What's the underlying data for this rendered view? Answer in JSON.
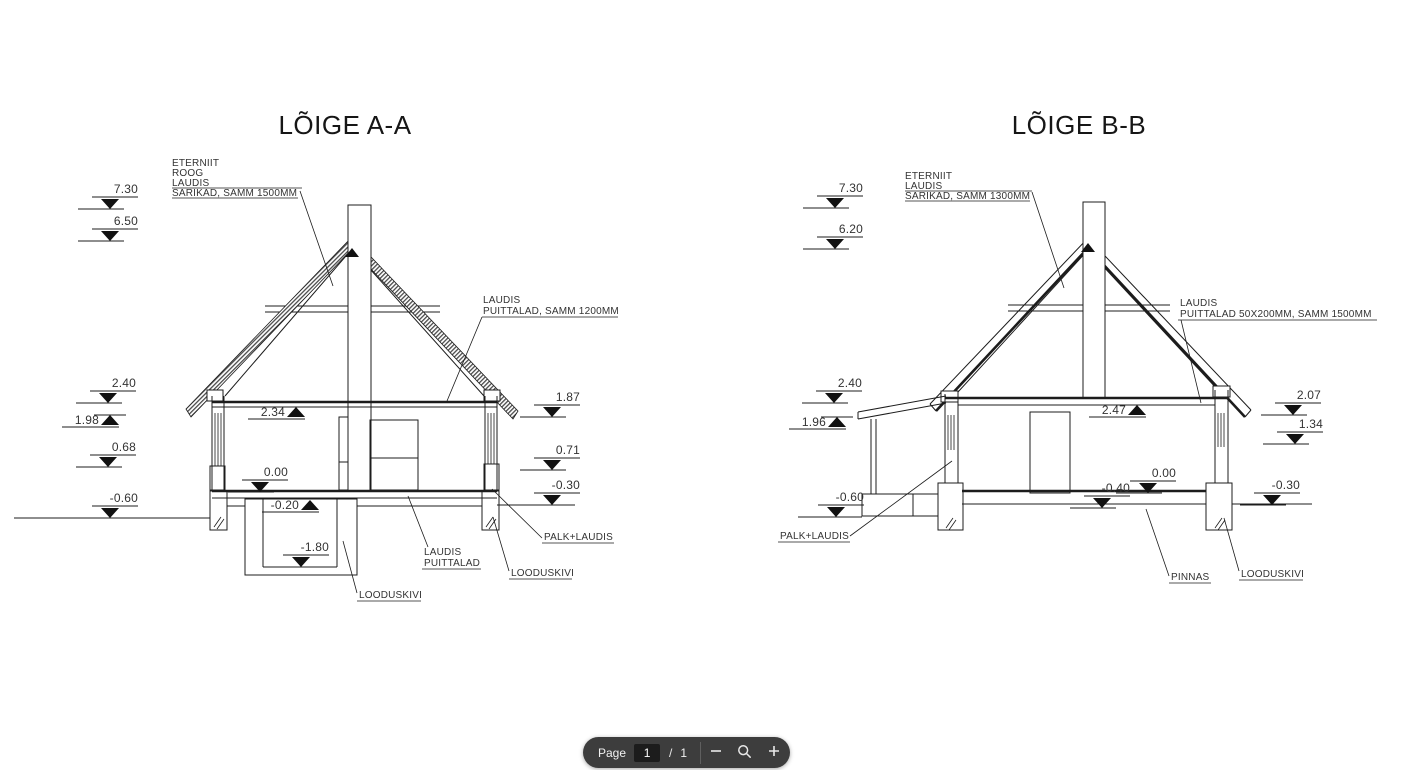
{
  "document": {
    "aa": {
      "title": "LÕIGE A-A",
      "roof_note": [
        "ETERNIIT",
        "ROOG",
        "LAUDIS",
        "SARIKAD, SAMM 1500MM"
      ],
      "beam_note": [
        "LAUDIS",
        "PUITTALAD, SAMM 1200MM"
      ],
      "wall_note": "PALK+LAUDIS",
      "floor_note": [
        "LAUDIS",
        "PUITTALAD"
      ],
      "foundation_note": "LOODUSKIVI",
      "cellar_note": "LOODUSKIVI",
      "elevations": {
        "left": [
          "7.30",
          "6.50",
          "2.40",
          "1.98",
          "0.68",
          "-0.60"
        ],
        "right": [
          "1.87",
          "0.71",
          "-0.30"
        ],
        "inner": [
          "2.34",
          "0.00",
          "-0.20",
          "-1.80"
        ]
      }
    },
    "bb": {
      "title": "LÕIGE B-B",
      "roof_note": [
        "ETERNIIT",
        "LAUDIS",
        "SARIKAD, SAMM 1300MM"
      ],
      "beam_note": [
        "LAUDIS",
        "PUITTALAD 50X200MM, SAMM 1500MM"
      ],
      "wall_note": "PALK+LAUDIS",
      "ground_note": "PINNAS",
      "foundation_note": "LOODUSKIVI",
      "elevations": {
        "left": [
          "7.30",
          "6.20",
          "2.40",
          "1.96",
          "-0.60"
        ],
        "right": [
          "2.07",
          "1.34",
          "-0.30"
        ],
        "inner": [
          "2.47",
          "0.00",
          "-0.40"
        ]
      }
    }
  },
  "toolbar": {
    "page_label": "Page",
    "page_value": "1",
    "separator": "/",
    "total_pages": "1",
    "icons": {
      "zoom_out": "minus-icon",
      "zoom_tool": "magnifier-icon",
      "zoom_in": "plus-icon"
    },
    "colors": {
      "background": "#3d3d3d",
      "input_background": "#1c1c1c",
      "text": "#f1f1f1",
      "divider": "#5f5f5f",
      "icon": "#e8e8e8"
    }
  }
}
